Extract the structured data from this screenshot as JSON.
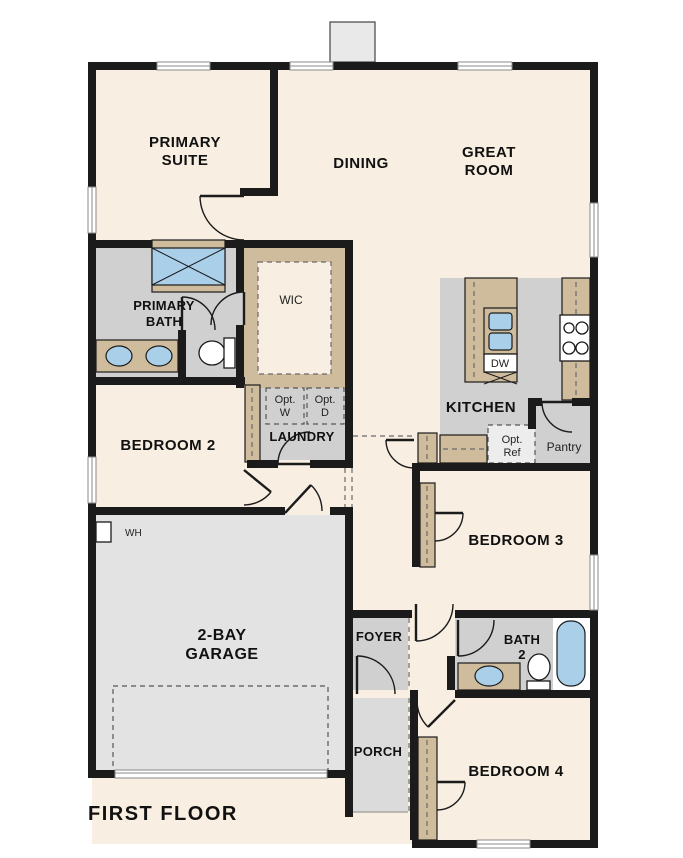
{
  "plan_title": "FIRST FLOOR",
  "rooms": {
    "primary_suite": {
      "line1": "PRIMARY",
      "line2": "SUITE"
    },
    "dining": {
      "line1": "DINING"
    },
    "great_room": {
      "line1": "GREAT",
      "line2": "ROOM"
    },
    "primary_bath": {
      "line1": "PRIMARY",
      "line2": "BATH"
    },
    "wic": {
      "line1": "WIC"
    },
    "bedroom2": {
      "line1": "BEDROOM 2"
    },
    "laundry": {
      "line1": "LAUNDRY"
    },
    "kitchen": {
      "line1": "KITCHEN"
    },
    "pantry": {
      "line1": "Pantry"
    },
    "bedroom3": {
      "line1": "BEDROOM 3"
    },
    "garage": {
      "line1": "2-BAY",
      "line2": "GARAGE"
    },
    "foyer": {
      "line1": "FOYER"
    },
    "bath2": {
      "line1": "BATH",
      "line2": "2"
    },
    "bedroom4": {
      "line1": "BEDROOM 4"
    },
    "porch": {
      "line1": "PORCH"
    }
  },
  "fixtures": {
    "dishwasher": "DW",
    "optional_washer": {
      "line1": "Opt.",
      "line2": "W"
    },
    "optional_dryer": {
      "line1": "Opt.",
      "line2": "D"
    },
    "optional_refrigerator": {
      "line1": "Opt.",
      "line2": "Ref"
    },
    "water_heater": "WH"
  },
  "colors": {
    "wall": "#1b1b1b",
    "floor_cream": "#f8eee1",
    "floor_gray": "#d0d0d0",
    "floor_garage": "#e3e3e3",
    "floor_porch": "#dbdbdb",
    "cabinet_tan": "#cfbc9c",
    "fixture_blue": "#aacfe9",
    "fireplace_gray": "#e9e9e9"
  }
}
